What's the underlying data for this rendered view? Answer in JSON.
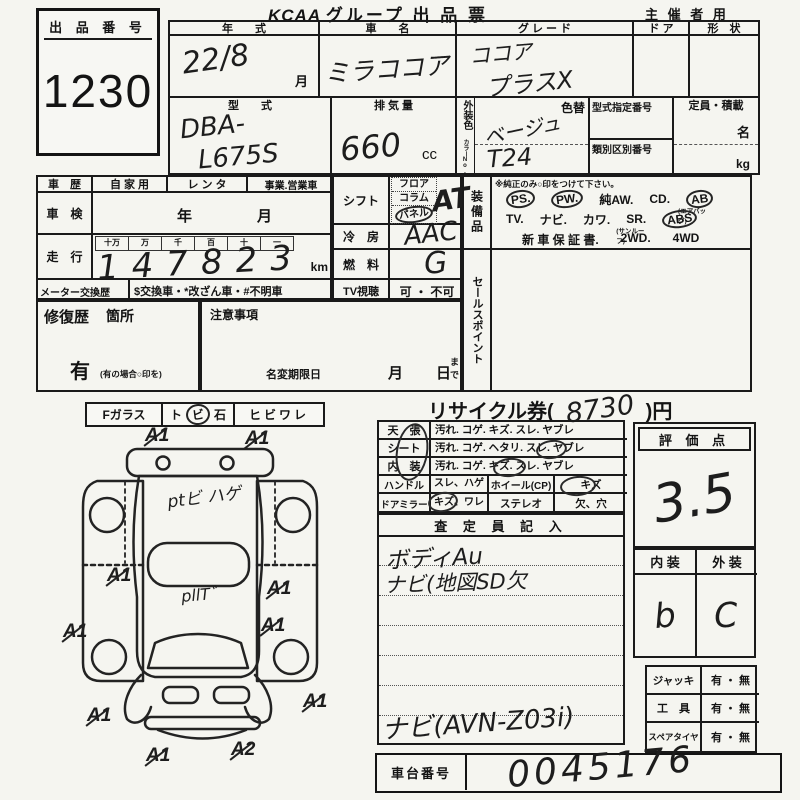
{
  "header": {
    "brand": "KCAA",
    "title": "グループ 出 品 票",
    "audience": "主 催 者 用"
  },
  "lot": {
    "label": "出 品 番 号",
    "number": "1230"
  },
  "vehicle": {
    "year_label": "年　　式",
    "year_value": "22/8",
    "year_unit": "月",
    "name_label": "車　　名",
    "name_value": "ミラココア",
    "grade_label": "グ レ ー ド",
    "grade_line1": "ココア",
    "grade_line2": "プラスX",
    "door_label": "ド ア",
    "shape_label": "形　状",
    "model_label": "型　　式",
    "model_line1": "DBA-",
    "model_line2": "L675S",
    "disp_label": "排 気 量",
    "disp_value": "660",
    "disp_unit": "cc",
    "color_label": "外装色",
    "color_sub": "カラーNo.",
    "color_value": "ベージュ",
    "color_code": "T24",
    "color_change": "色替",
    "spec_label": "型式指定番号",
    "class_label": "類別区別番号",
    "cap_label": "定員・積載",
    "cap_persons": "名",
    "cap_weight": "kg"
  },
  "history": {
    "label": "車　歴",
    "opt1": "自 家 用",
    "opt2": "レ ン タ",
    "opt3": "事業.営業車",
    "shaken_label": "車　検",
    "shaken_year": "年",
    "shaken_month": "月",
    "run_label": "走　行",
    "d1": "十万",
    "d2": "万",
    "d3": "千",
    "d4": "百",
    "d5": "十",
    "d6": "一",
    "v1": "1",
    "v2": "4",
    "v3": "7",
    "v4": "8",
    "v5": "2",
    "v6": "3",
    "unit": "km",
    "meter_label": "メーター交換歴",
    "meter_text": "$交換車・*改ざん車・#不明車"
  },
  "controls": {
    "shift_label": "シフト",
    "shift1": "フロア",
    "shift2": "コラム",
    "shift3": "パネル",
    "shift_value": "AT",
    "ac_label": "冷　房",
    "ac_value": "AAC",
    "fuel_label": "燃　料",
    "fuel_value": "G",
    "tv_label": "TV視聴",
    "tv_value": "可 ・ 不可"
  },
  "equipment": {
    "label": "装備品",
    "note": "※純正のみ○印をつけて下さい。",
    "ps": "PS.",
    "pw": "PW.",
    "aw": "純AW.",
    "cd": "CD.",
    "ab": "AB",
    "ab_sub": "(エアバッグ)",
    "tv": "TV.",
    "navi": "ナビ.",
    "leather": "カワ.",
    "sr": "SR.",
    "sr_sub": "(サンルーフ)",
    "abs": "ABS",
    "warranty": "新 車 保 証 書.",
    "wd2": "2WD.",
    "wd4": "4WD"
  },
  "sales_point": "セールスポイント",
  "repair": {
    "label": "修復歴",
    "sub": "箇所",
    "yes": "有",
    "note": "(有の場合○印を)"
  },
  "caution": {
    "label": "注意事項",
    "rename": "名変期限日",
    "month": "月",
    "day": "日",
    "until": "まで"
  },
  "glass": {
    "label": "Fガラス",
    "opt1_a": "ト",
    "opt1_b": "ビ",
    "opt1_c": "石",
    "opt2": "ヒビワレ"
  },
  "diagram": {
    "m1": "A1",
    "m2": "A1",
    "m3": "A1",
    "m4": "A1",
    "m5": "A1",
    "m6": "A1",
    "m7": "A1",
    "m8": "A1",
    "m9": "A1",
    "m10": "A2",
    "note1": "ptビ ハゲ",
    "note2": "pllT゛"
  },
  "recycle": {
    "label": "リサイクル券(",
    "value": "8730",
    "suffix": ")円"
  },
  "condition": {
    "ceiling_label": "天　張",
    "ceiling": "汚れ. コゲ. キズ. スレ. ヤブレ",
    "seat_label": "シート",
    "seat": "汚れ. コゲ. ヘタリ. スレ. ヤブレ",
    "interior_label": "内　装",
    "interior": "汚れ. コゲ. キズ. スレ. ヤブレ",
    "handle_label": "ハンドル",
    "handle": "スレ、ハゲ",
    "wheel_label": "ホイール(CP)",
    "wheel": "キズ",
    "mirror_label": "ドアミラー",
    "mirror": "キズ、ワレ",
    "stereo_label": "ステレオ",
    "stereo": "欠、穴"
  },
  "score": {
    "label": "評 価 点",
    "value": "3.5"
  },
  "grade_box": {
    "interior_label": "内 装",
    "exterior_label": "外 装",
    "interior": "b",
    "exterior": "C"
  },
  "inspector": {
    "label": "査 定 員 記 入",
    "line1": "ボディAu",
    "line2": "ナビ(地図SD欠",
    "line3": "ナビ(AVN-Z03i)"
  },
  "accessories": {
    "jack_label": "ジャッキ",
    "jack": "有 ・ 無",
    "tool_label": "工　具",
    "tool": "有 ・ 無",
    "spare_label": "スペアタイヤ",
    "spare": "有 ・ 無"
  },
  "chassis": {
    "label": "車台番号",
    "value": "0045176"
  }
}
